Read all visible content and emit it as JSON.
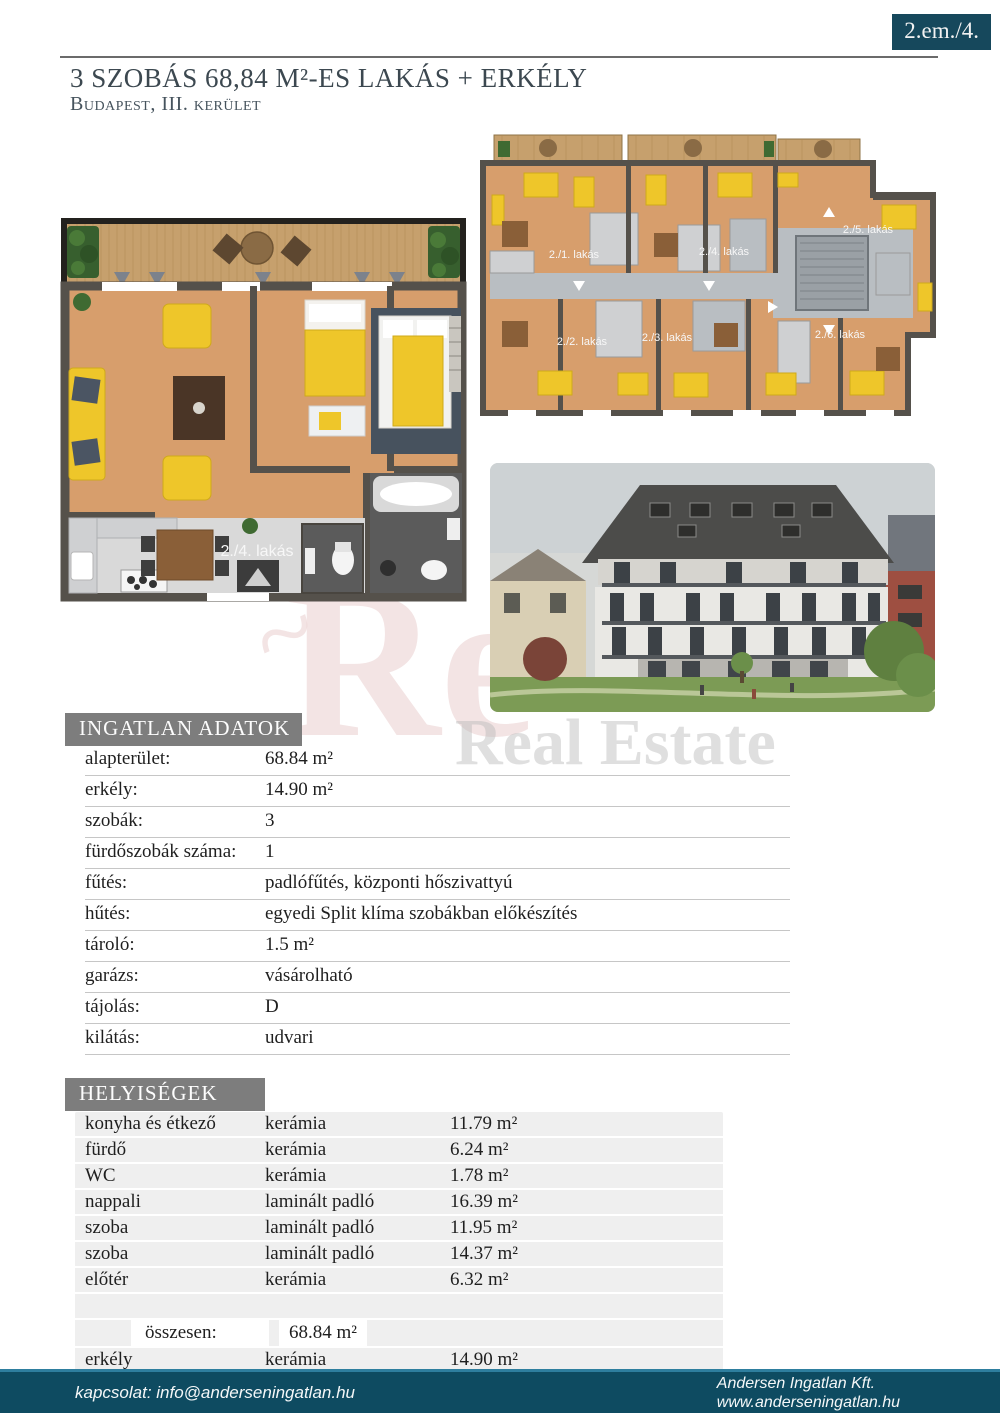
{
  "page": {
    "badge": "2.em./4.",
    "title": "3 SZOBÁS 68,84 M²-ES LAKÁS + ERKÉLY",
    "subtitle": "Budapest, III. kerület"
  },
  "watermark": {
    "big": "Re",
    "swirl": "~",
    "text": "Real Estate"
  },
  "floor_plans": {
    "apartment_label": "2./4. lakás",
    "units": [
      "2./1. lakás",
      "2./2. lakás",
      "2./3. lakás",
      "2./4. lakás",
      "2./5. lakás",
      "2./6. lakás"
    ]
  },
  "property_data": {
    "header": "INGATLAN ADATOK",
    "rows": [
      {
        "label": "alapterület:",
        "value": "68.84 m²"
      },
      {
        "label": "erkély:",
        "value": "14.90 m²"
      },
      {
        "label": "szobák:",
        "value": "3"
      },
      {
        "label": "fürdőszobák száma:",
        "value": "1"
      },
      {
        "label": "fűtés:",
        "value": "padlófűtés, központi hőszivattyú"
      },
      {
        "label": "hűtés:",
        "value": "egyedi Split klíma szobákban előkészítés"
      },
      {
        "label": "tároló:",
        "value": "1.5 m²"
      },
      {
        "label": "garázs:",
        "value": "vásárolható"
      },
      {
        "label": "tájolás:",
        "value": "D"
      },
      {
        "label": "kilátás:",
        "value": "udvari"
      }
    ]
  },
  "rooms": {
    "header": "HELYISÉGEK",
    "rows": [
      {
        "name": "konyha és étkező",
        "material": "kerámia",
        "area": "11.79 m²"
      },
      {
        "name": "fürdő",
        "material": "kerámia",
        "area": "6.24 m²"
      },
      {
        "name": "WC",
        "material": "kerámia",
        "area": "1.78 m²"
      },
      {
        "name": "nappali",
        "material": "laminált padló",
        "area": "16.39 m²"
      },
      {
        "name": "szoba",
        "material": "laminált padló",
        "area": "11.95 m²"
      },
      {
        "name": "szoba",
        "material": "laminált padló",
        "area": "14.37 m²"
      },
      {
        "name": "előtér",
        "material": "kerámia",
        "area": "6.32 m²"
      }
    ],
    "total_label": "összesen:",
    "total_value": "68.84 m²",
    "balcony_row": {
      "name": "erkély",
      "material": "kerámia",
      "area": "14.90 m²"
    }
  },
  "footer": {
    "contact": "kapcsolat: info@anderseningatlan.hu",
    "company": "Andersen Ingatlan Kft.",
    "website": "www.anderseningatlan.hu"
  },
  "colors": {
    "accent_teal": "#16485c",
    "footer_teal": "#0e4b61",
    "footer_edge": "#2e7e9e",
    "section_gray": "#7d7d7d",
    "title_slate": "#3c4850",
    "table_bg": "#efefef",
    "plan_floor": "#d79e6c",
    "plan_wall": "#55514b",
    "terrace_wood": "#c6a06d",
    "furniture_yellow": "#eec62a",
    "watermark_pink": "#c57878"
  }
}
